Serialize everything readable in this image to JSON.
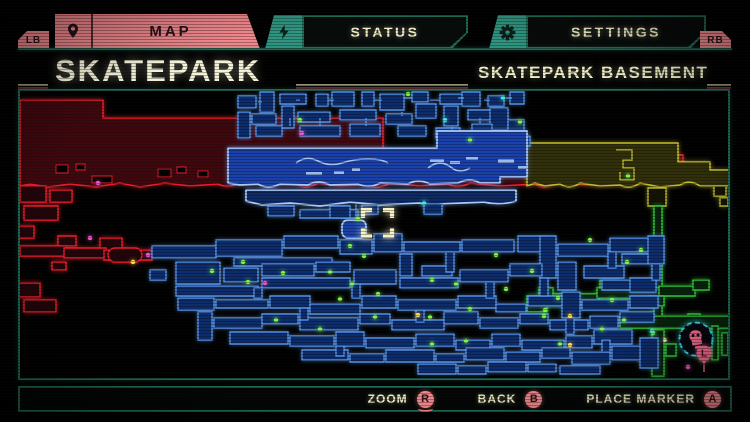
{
  "colors": {
    "salmon": "#f2888d",
    "salmon_text": "#27141a",
    "teal": "#2f9480",
    "teal_line": "#1f6b57",
    "cream": "#f1eec6",
    "red_stroke": "#e81d2c",
    "red_fill": "#3f070e",
    "red_room_fill": "#23040a",
    "band_fill": "#1a41ab",
    "band_stroke": "#aac8f8",
    "room_fill": "#0d2c6c",
    "room_stroke": "#5d9af0",
    "olive_fill": "#31300b",
    "olive_stroke": "#c0ba30",
    "green_fill": "#07230c",
    "green_stroke": "#33c33c",
    "dot_green": "#7df24f",
    "dot_yellow": "#ffd94e",
    "dot_cyan": "#41e8e8",
    "dot_magenta": "#f257c8",
    "dot_cream": "#f6f0c2",
    "boss_ring": "#35d6e6",
    "boss_pink": "#ef6a8e",
    "marker_cream": "#f6f2c4"
  },
  "tab_bar": {
    "lb_label": "LB",
    "rb_label": "RB",
    "tabs": [
      {
        "id": "map",
        "label": "MAP",
        "icon": "location-pin-icon",
        "active": true
      },
      {
        "id": "status",
        "label": "STATUS",
        "icon": "lightning-bolt-icon",
        "active": false
      },
      {
        "id": "settings",
        "label": "SETTINGS",
        "icon": "gear-icon",
        "active": false
      }
    ]
  },
  "header": {
    "title": "SKATEPARK",
    "subtitle": "SKATEPARK BASEMENT"
  },
  "map": {
    "regions": [
      {
        "name": "upper-west-zone",
        "color": "red"
      },
      {
        "name": "central-zone",
        "color": "blue"
      },
      {
        "name": "east-zone",
        "color": "olive"
      },
      {
        "name": "southeast-zone",
        "color": "green"
      },
      {
        "name": "southwest-corridors",
        "color": "red"
      }
    ],
    "player_marker": {
      "x": 377,
      "y": 222
    },
    "boss_marker": {
      "x": 696,
      "y": 339
    },
    "letter_marker": {
      "label": "L",
      "x": 704,
      "y": 353
    },
    "dots": {
      "green": [
        [
          350,
          246
        ],
        [
          364,
          256
        ],
        [
          330,
          272
        ],
        [
          283,
          273
        ],
        [
          212,
          271
        ],
        [
          248,
          282
        ],
        [
          352,
          284
        ],
        [
          378,
          294
        ],
        [
          340,
          299
        ],
        [
          432,
          280
        ],
        [
          456,
          284
        ],
        [
          506,
          289
        ],
        [
          532,
          271
        ],
        [
          558,
          298
        ],
        [
          470,
          309
        ],
        [
          430,
          317
        ],
        [
          375,
          317
        ],
        [
          320,
          329
        ],
        [
          432,
          344
        ],
        [
          466,
          341
        ],
        [
          560,
          344
        ],
        [
          602,
          329
        ],
        [
          612,
          300
        ],
        [
          627,
          262
        ],
        [
          641,
          250
        ],
        [
          590,
          240
        ],
        [
          544,
          316
        ],
        [
          358,
          219
        ],
        [
          300,
          120
        ],
        [
          470,
          140
        ],
        [
          408,
          94
        ],
        [
          520,
          122
        ],
        [
          545,
          310
        ],
        [
          653,
          333
        ],
        [
          624,
          320
        ],
        [
          628,
          176
        ],
        [
          243,
          262
        ],
        [
          276,
          320
        ],
        [
          496,
          255
        ]
      ],
      "yellow": [
        [
          418,
          315
        ],
        [
          570,
          316
        ],
        [
          570,
          345
        ],
        [
          133,
          262
        ]
      ],
      "cyan": [
        [
          503,
          98
        ],
        [
          424,
          203
        ],
        [
          652,
          331
        ],
        [
          445,
          120
        ]
      ],
      "magenta": [
        [
          265,
          283
        ],
        [
          148,
          255
        ],
        [
          98,
          183
        ],
        [
          90,
          238
        ],
        [
          688,
          367
        ],
        [
          302,
          133
        ]
      ],
      "cream": [
        [
          688,
          342
        ],
        [
          665,
          340
        ],
        [
          707,
          341
        ]
      ]
    }
  },
  "bottom_bar": {
    "actions": [
      {
        "label": "ZOOM",
        "button": "R"
      },
      {
        "label": "BACK",
        "button": "B"
      },
      {
        "label": "PLACE MARKER",
        "button": "A"
      }
    ]
  }
}
